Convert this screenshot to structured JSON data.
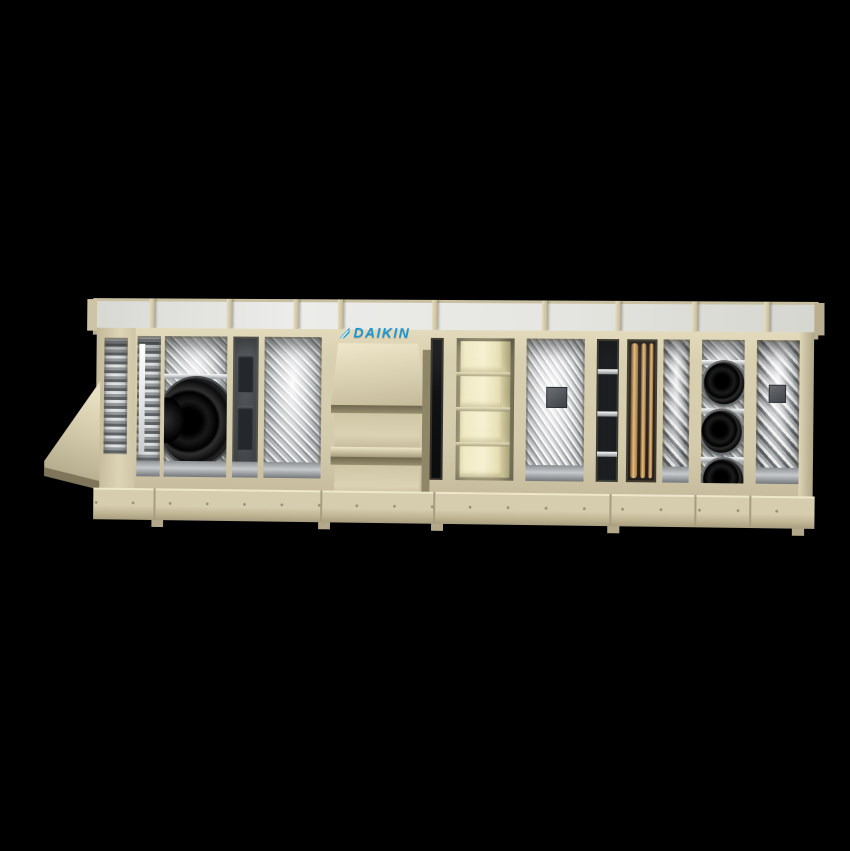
{
  "page": {
    "background": "#000000"
  },
  "brand": {
    "logo_text": "DAIKIN",
    "logo_color": "#1796d6",
    "logo_icon": "daikin-flag-icon"
  },
  "unit": {
    "product_type": "modular-air-handling-unit",
    "palette": {
      "bg": "#000000",
      "cabinet": "#d9d0b2",
      "cabinet_dark": "#a89e80",
      "cabinet_light": "#ece4c9",
      "roof": "#e8e8e4",
      "brand_blue": "#1796d6",
      "metal_light": "#d7d9da",
      "metal_dark": "#6a6e71",
      "fan_black": "#0a0a0a",
      "filter_cream": "#f3edca",
      "copper": "#c29457"
    },
    "sections": [
      "left intake hood",
      "left end panel with damper window",
      "damper louver bay",
      "supply fan bay",
      "slotted access panel bay",
      "mesh screen bay",
      "front panel with DAIKIN logo",
      "three-tier louvered intake hood",
      "narrow service slit",
      "filter bank bay",
      "coil fin bay",
      "dark slat bay",
      "copper piping bay",
      "mesh bay",
      "fan wall bay with three fans",
      "right end mesh bay"
    ],
    "counts": {
      "roof_ribs": 9,
      "filter_blocks": 4,
      "fan_wall_fans": 3,
      "large_fans": 1
    }
  }
}
